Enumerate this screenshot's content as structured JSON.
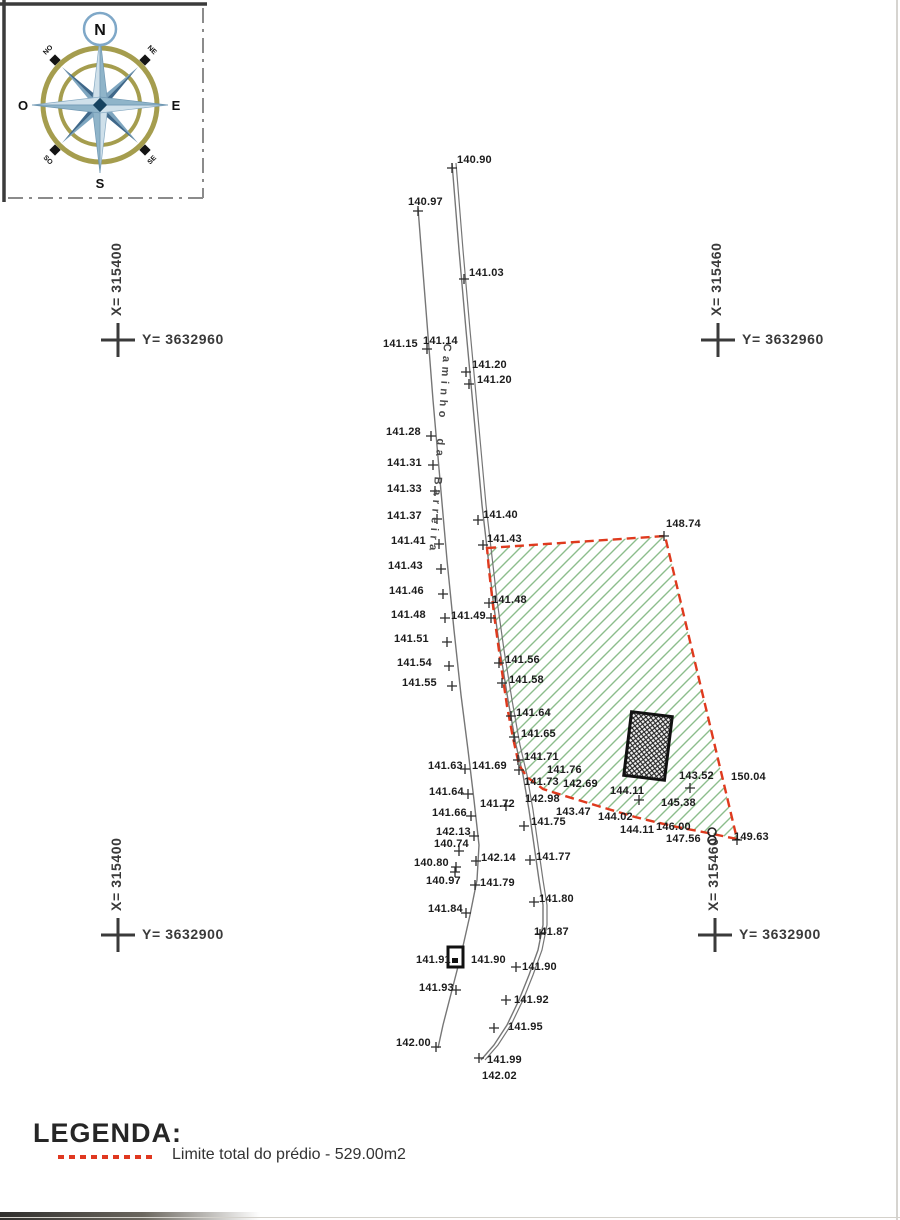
{
  "compass": {
    "n": "N",
    "e": "E",
    "s": "S",
    "o": "O",
    "ne": "NE",
    "se": "SE",
    "so": "SO",
    "no": "NO"
  },
  "crosses": [
    {
      "x_label": "X= 315400",
      "y_label": "Y= 3632960",
      "cx": 118,
      "cy": 340
    },
    {
      "x_label": "X= 315460",
      "y_label": "Y= 3632960",
      "cx": 718,
      "cy": 340
    },
    {
      "x_label": "X= 315400",
      "y_label": "Y= 3632900",
      "cx": 118,
      "cy": 935
    },
    {
      "x_label": "X= 315460",
      "y_label": "Y= 3632900",
      "cx": 715,
      "cy": 935
    }
  ],
  "road": {
    "name": "Caminho da Barreira",
    "left_edge": [
      [
        418,
        208
      ],
      [
        426,
        310
      ],
      [
        433,
        400
      ],
      [
        440,
        480
      ],
      [
        447,
        560
      ],
      [
        454,
        630
      ],
      [
        461,
        695
      ],
      [
        468,
        750
      ],
      [
        474,
        800
      ],
      [
        479,
        845
      ],
      [
        477,
        880
      ],
      [
        470,
        915
      ],
      [
        461,
        955
      ],
      [
        452,
        990
      ],
      [
        443,
        1025
      ],
      [
        438,
        1048
      ]
    ],
    "right_edge": [
      [
        452,
        163
      ],
      [
        459,
        250
      ],
      [
        466,
        330
      ],
      [
        472,
        395
      ],
      [
        477,
        450
      ],
      [
        482,
        505
      ],
      [
        487,
        548
      ],
      [
        493,
        600
      ],
      [
        500,
        650
      ],
      [
        508,
        700
      ],
      [
        516,
        745
      ],
      [
        523,
        775
      ],
      [
        529,
        810
      ],
      [
        534,
        845
      ],
      [
        539,
        880
      ],
      [
        543,
        905
      ],
      [
        543,
        925
      ],
      [
        538,
        950
      ],
      [
        529,
        975
      ],
      [
        519,
        1000
      ],
      [
        507,
        1025
      ],
      [
        494,
        1045
      ],
      [
        481,
        1060
      ]
    ],
    "double_gap": 4
  },
  "boundary": {
    "color": "#df3a1e",
    "points": [
      [
        487,
        548
      ],
      [
        665,
        536
      ],
      [
        737,
        839
      ],
      [
        708,
        833
      ],
      [
        672,
        826
      ],
      [
        635,
        817
      ],
      [
        598,
        806
      ],
      [
        565,
        796
      ],
      [
        543,
        789
      ],
      [
        527,
        777
      ],
      [
        519,
        765
      ],
      [
        513,
        738
      ],
      [
        507,
        706
      ],
      [
        500,
        658
      ],
      [
        494,
        614
      ],
      [
        489,
        570
      ]
    ]
  },
  "building": {
    "cx": 648,
    "cy": 746,
    "w": 41,
    "h": 64,
    "rot": 7
  },
  "road_marker": {
    "x": 448,
    "y": 947,
    "w": 15,
    "h": 20
  },
  "well": {
    "x": 712,
    "y": 836
  },
  "elevation_points": [
    {
      "v": "140.90",
      "l": [
        457,
        155
      ],
      "t": [
        452,
        168
      ]
    },
    {
      "v": "140.97",
      "l": [
        408,
        197
      ],
      "t": [
        418,
        211
      ]
    },
    {
      "v": "141.03",
      "l": [
        469,
        268
      ],
      "t": [
        464,
        279
      ]
    },
    {
      "v": "141.14",
      "l": [
        423,
        336
      ]
    },
    {
      "v": "141.15",
      "l": [
        383,
        339
      ],
      "t": [
        427,
        349
      ]
    },
    {
      "v": "141.20",
      "l": [
        472,
        360
      ],
      "t": [
        466,
        372
      ]
    },
    {
      "v": "141.20",
      "l": [
        477,
        375
      ],
      "t": [
        469,
        384
      ]
    },
    {
      "v": "141.28",
      "l": [
        386,
        427
      ],
      "t": [
        431,
        436
      ]
    },
    {
      "v": "141.31",
      "l": [
        387,
        458
      ],
      "t": [
        433,
        465
      ]
    },
    {
      "v": "141.33",
      "l": [
        387,
        484
      ],
      "t": [
        435,
        491
      ]
    },
    {
      "v": "141.37",
      "l": [
        387,
        511
      ],
      "t": [
        437,
        519
      ]
    },
    {
      "v": "141.41",
      "l": [
        391,
        536
      ],
      "t": [
        439,
        544
      ]
    },
    {
      "v": "141.43",
      "l": [
        388,
        561
      ],
      "t": [
        441,
        569
      ]
    },
    {
      "v": "141.46",
      "l": [
        389,
        586
      ],
      "t": [
        443,
        594
      ]
    },
    {
      "v": "141.48",
      "l": [
        391,
        610
      ],
      "t": [
        445,
        618
      ]
    },
    {
      "v": "141.51",
      "l": [
        394,
        634
      ],
      "t": [
        447,
        642
      ]
    },
    {
      "v": "141.54",
      "l": [
        397,
        658
      ],
      "t": [
        449,
        666
      ]
    },
    {
      "v": "141.55",
      "l": [
        402,
        678
      ],
      "t": [
        452,
        686
      ]
    },
    {
      "v": "141.40",
      "l": [
        483,
        510
      ],
      "t": [
        478,
        520
      ]
    },
    {
      "v": "141.43",
      "l": [
        487,
        534
      ],
      "t": [
        483,
        545
      ]
    },
    {
      "v": "141.48",
      "l": [
        492,
        595
      ],
      "t": [
        489,
        603
      ]
    },
    {
      "v": "141.49",
      "l": [
        451,
        611
      ],
      "t": [
        491,
        618
      ]
    },
    {
      "v": "141.56",
      "l": [
        505,
        655
      ],
      "t": [
        499,
        663
      ]
    },
    {
      "v": "141.58",
      "l": [
        509,
        675
      ],
      "t": [
        502,
        683
      ]
    },
    {
      "v": "141.64",
      "l": [
        516,
        708
      ],
      "t": [
        511,
        716
      ]
    },
    {
      "v": "141.65",
      "l": [
        521,
        729
      ],
      "t": [
        514,
        737
      ]
    },
    {
      "v": "141.71",
      "l": [
        524,
        752
      ],
      "t": [
        518,
        760
      ]
    },
    {
      "v": "141.63",
      "l": [
        428,
        761
      ],
      "t": [
        465,
        769
      ]
    },
    {
      "v": "141.69",
      "l": [
        472,
        761
      ],
      "t": [
        519,
        770
      ]
    },
    {
      "v": "141.76",
      "l": [
        547,
        765
      ]
    },
    {
      "v": "141.73",
      "l": [
        524,
        777
      ]
    },
    {
      "v": "142.69",
      "l": [
        563,
        779
      ]
    },
    {
      "v": "142.98",
      "l": [
        525,
        794
      ]
    },
    {
      "v": "143.47",
      "l": [
        556,
        807
      ]
    },
    {
      "v": "141.64",
      "l": [
        429,
        787
      ],
      "t": [
        468,
        794
      ]
    },
    {
      "v": "141.72",
      "l": [
        480,
        799
      ],
      "t": [
        506,
        806
      ]
    },
    {
      "v": "141.66",
      "l": [
        432,
        808
      ],
      "t": [
        471,
        816
      ]
    },
    {
      "v": "142.13",
      "l": [
        436,
        827
      ],
      "t": [
        474,
        836
      ]
    },
    {
      "v": "140.74",
      "l": [
        434,
        839
      ],
      "t": [
        459,
        851
      ]
    },
    {
      "v": "141.75",
      "l": [
        531,
        817
      ],
      "t": [
        524,
        826
      ]
    },
    {
      "v": "140.80",
      "l": [
        414,
        858
      ],
      "t": [
        456,
        867
      ]
    },
    {
      "v": "142.14",
      "l": [
        481,
        853
      ],
      "t": [
        476,
        861
      ]
    },
    {
      "v": "141.77",
      "l": [
        536,
        852
      ],
      "t": [
        530,
        860
      ]
    },
    {
      "v": "140.97",
      "l": [
        426,
        876
      ],
      "t": [
        455,
        872
      ]
    },
    {
      "v": "141.79",
      "l": [
        480,
        878
      ],
      "t": [
        475,
        885
      ]
    },
    {
      "v": "141.84",
      "l": [
        428,
        904
      ],
      "t": [
        466,
        913
      ]
    },
    {
      "v": "141.80",
      "l": [
        539,
        894
      ],
      "t": [
        534,
        902
      ]
    },
    {
      "v": "141.87",
      "l": [
        534,
        927
      ],
      "t": [
        540,
        934
      ]
    },
    {
      "v": "141.91",
      "l": [
        416,
        955
      ]
    },
    {
      "v": "141.90",
      "l": [
        471,
        955
      ]
    },
    {
      "v": "141.90",
      "l": [
        522,
        962
      ],
      "t": [
        516,
        967
      ]
    },
    {
      "v": "141.93",
      "l": [
        419,
        983
      ],
      "t": [
        456,
        990
      ]
    },
    {
      "v": "141.92",
      "l": [
        514,
        995
      ],
      "t": [
        506,
        1000
      ]
    },
    {
      "v": "141.95",
      "l": [
        508,
        1022
      ],
      "t": [
        494,
        1028
      ]
    },
    {
      "v": "142.00",
      "l": [
        396,
        1038
      ],
      "t": [
        436,
        1047
      ]
    },
    {
      "v": "141.99",
      "l": [
        487,
        1055
      ],
      "t": [
        479,
        1058
      ]
    },
    {
      "v": "142.02",
      "l": [
        482,
        1071
      ]
    },
    {
      "v": "148.74",
      "l": [
        666,
        519
      ],
      "t": [
        664,
        536
      ]
    },
    {
      "v": "143.52",
      "l": [
        679,
        771
      ],
      "t": [
        690,
        788
      ]
    },
    {
      "v": "150.04",
      "l": [
        731,
        772
      ]
    },
    {
      "v": "144.11",
      "l": [
        610,
        786
      ],
      "t": [
        639,
        800
      ]
    },
    {
      "v": "145.38",
      "l": [
        661,
        798
      ]
    },
    {
      "v": "144.02",
      "l": [
        598,
        812
      ]
    },
    {
      "v": "144.11",
      "l": [
        620,
        825
      ]
    },
    {
      "v": "146.00",
      "l": [
        656,
        822
      ]
    },
    {
      "v": "147.56",
      "l": [
        666,
        834
      ]
    },
    {
      "v": "149.63",
      "l": [
        734,
        832
      ],
      "t": [
        737,
        840
      ]
    }
  ],
  "legend": {
    "title": "LEGENDA:",
    "item_label": "Limite total do prédio - 529.00m2",
    "swatch_color": "#e03820"
  },
  "colors": {
    "hatch_green": "#8cbd8c",
    "road": "#767676",
    "boundary_red": "#df3a1e"
  }
}
